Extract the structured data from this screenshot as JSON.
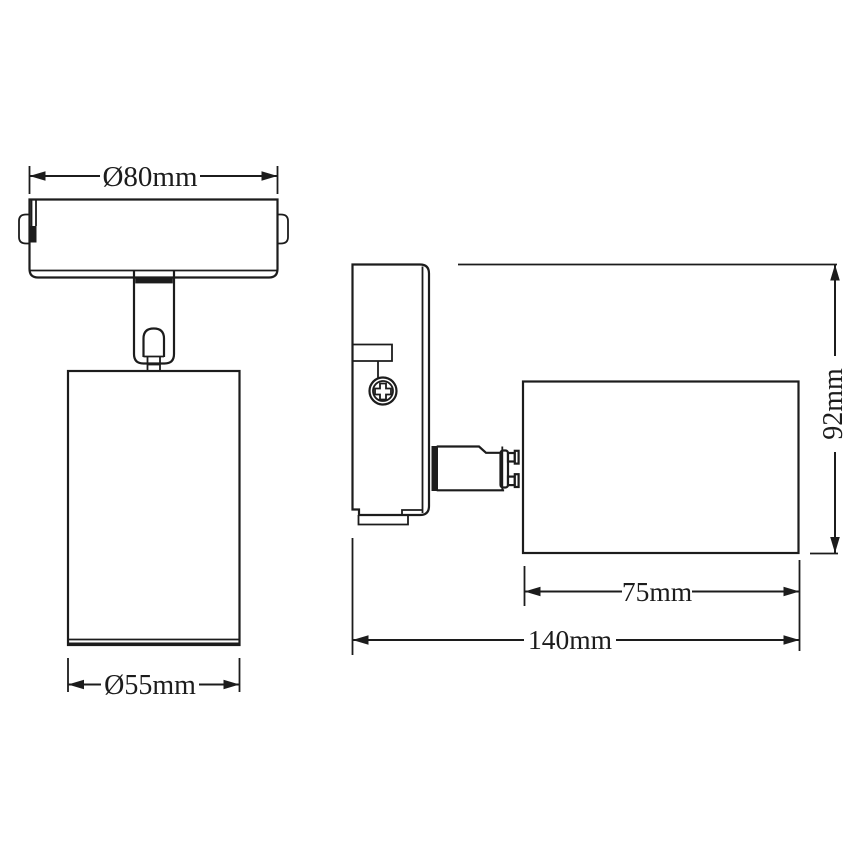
{
  "drawing": {
    "background": "#ffffff",
    "line_color": "#1c1c1c",
    "dimensions": {
      "plate_diameter": "Ø80mm",
      "body_diameter": "Ø55mm",
      "height": "92mm",
      "body_length": "75mm",
      "total_depth": "140mm"
    }
  }
}
